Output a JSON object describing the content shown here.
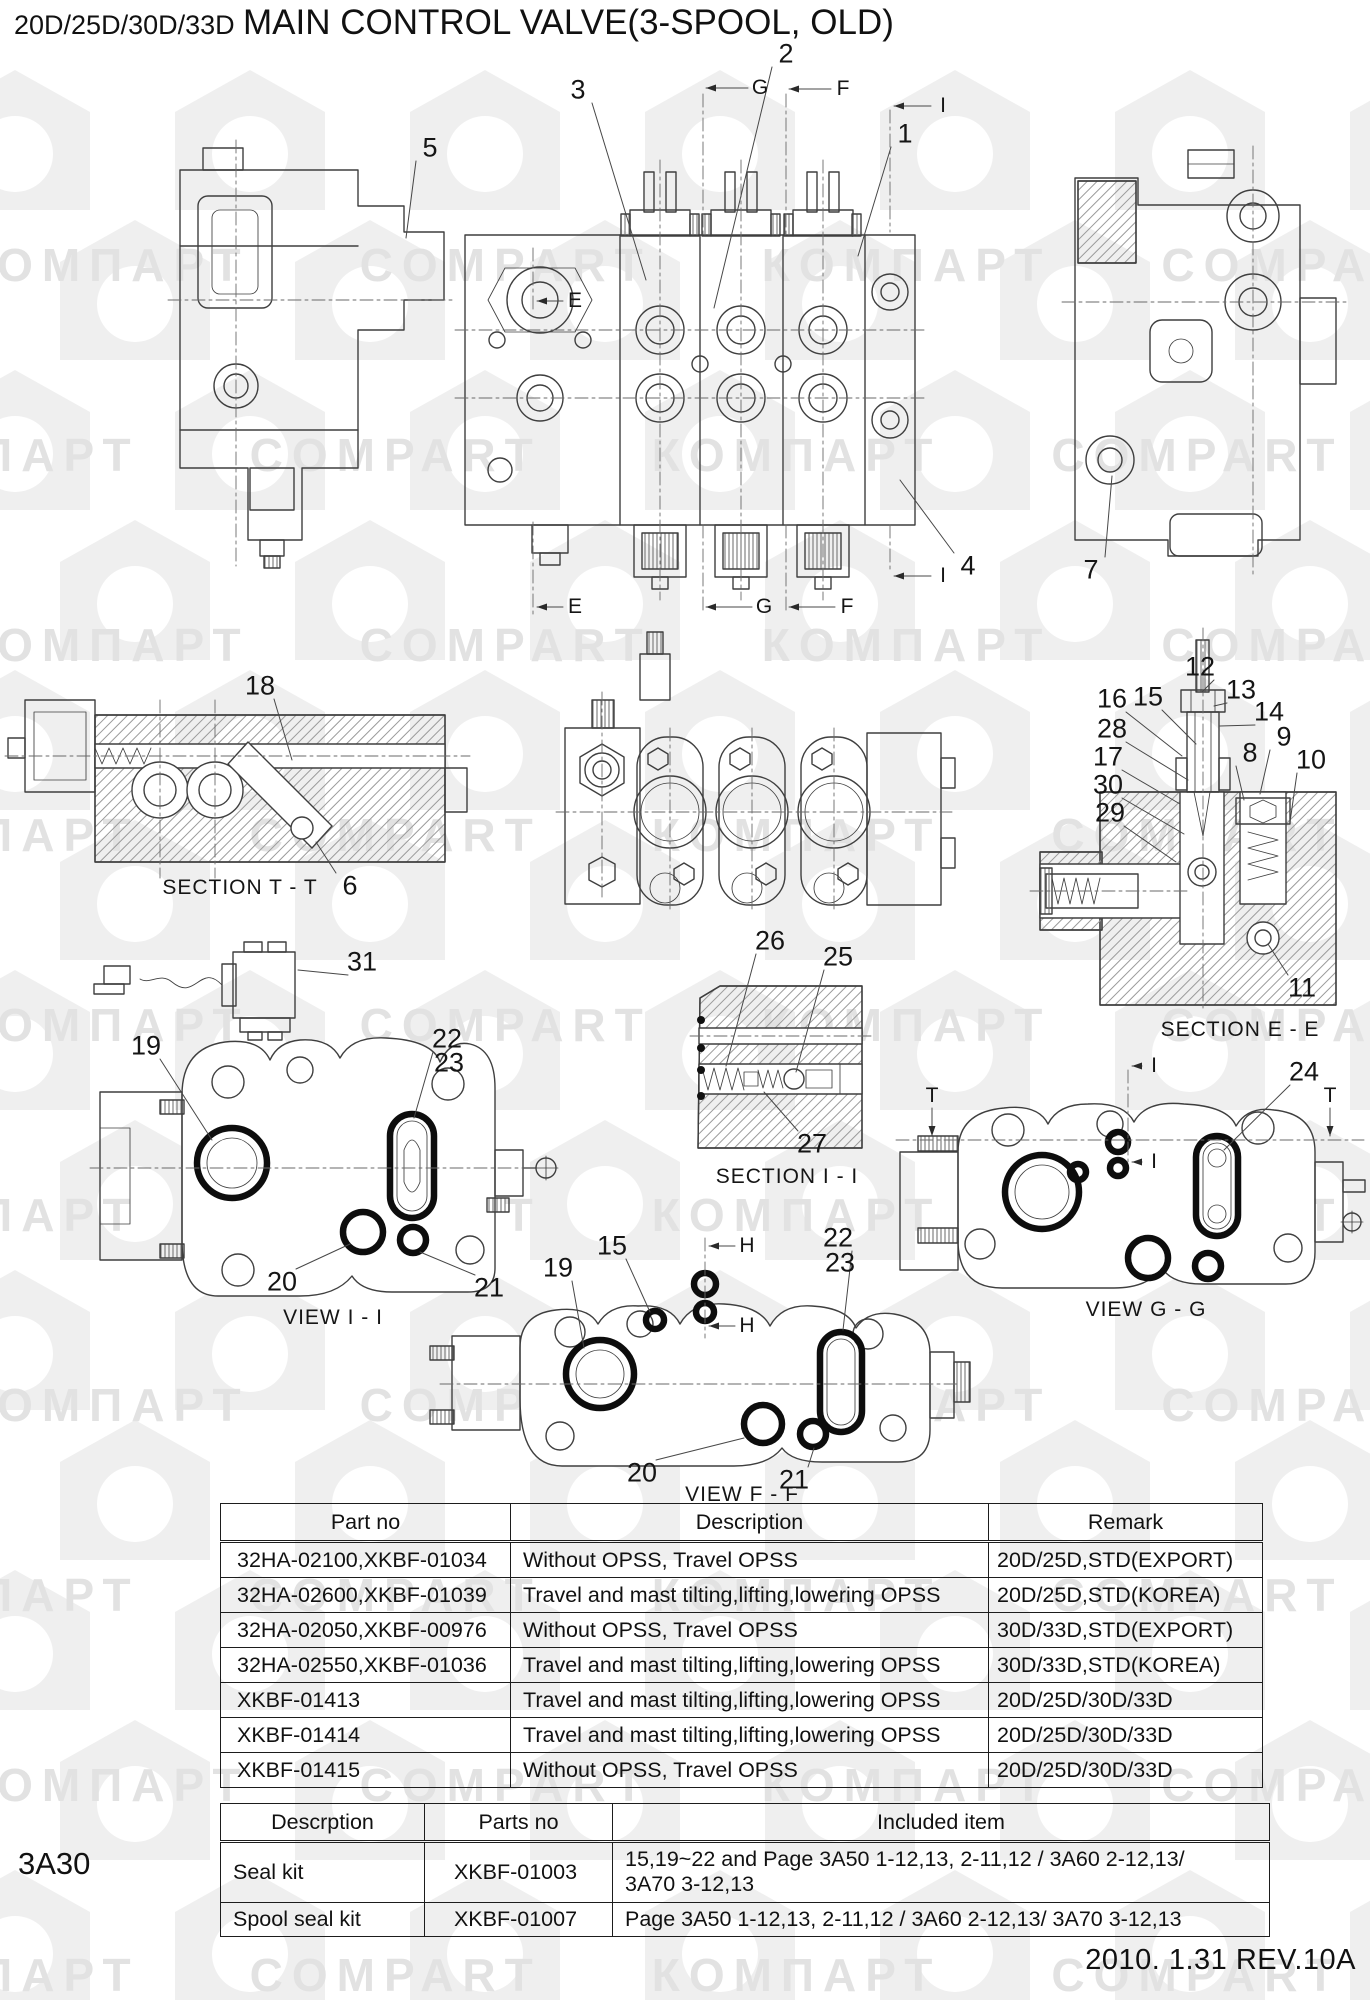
{
  "page": {
    "model": "20D/25D/30D/33D",
    "title": "MAIN CONTROL VALVE(3-SPOOL, OLD)",
    "page_code": "3A30",
    "revision": "2010. 1.31  REV.10A"
  },
  "watermark": {
    "cyrillic": "КОМПАРТ",
    "latin": "COMPART"
  },
  "diagram": {
    "callouts": [
      {
        "t": "1",
        "x": 905,
        "y": 134,
        "lx": 858,
        "ly": 256
      },
      {
        "t": "2",
        "x": 786,
        "y": 54,
        "lx": 714,
        "ly": 308
      },
      {
        "t": "3",
        "x": 578,
        "y": 90,
        "lx": 646,
        "ly": 280
      },
      {
        "t": "4",
        "x": 968,
        "y": 566,
        "lx": 900,
        "ly": 480
      },
      {
        "t": "5",
        "x": 430,
        "y": 148,
        "lx": 406,
        "ly": 238
      },
      {
        "t": "6",
        "x": 350,
        "y": 886,
        "lx": 316,
        "ly": 842
      },
      {
        "t": "7",
        "x": 1091,
        "y": 570,
        "lx": 1112,
        "ly": 476
      },
      {
        "t": "8",
        "x": 1250,
        "y": 753,
        "lx": 1244,
        "ly": 800
      },
      {
        "t": "9",
        "x": 1284,
        "y": 737,
        "lx": 1260,
        "ly": 794
      },
      {
        "t": "10",
        "x": 1311,
        "y": 760,
        "lx": 1290,
        "ly": 822
      },
      {
        "t": "11",
        "x": 1302,
        "y": 988,
        "lx": 1268,
        "ly": 944
      },
      {
        "t": "12",
        "x": 1200,
        "y": 667,
        "lx": 1202,
        "ly": 692
      },
      {
        "t": "13",
        "x": 1241,
        "y": 690,
        "lx": 1214,
        "ly": 706
      },
      {
        "t": "14",
        "x": 1269,
        "y": 712,
        "lx": 1220,
        "ly": 726
      },
      {
        "t": "15",
        "x": 1148,
        "y": 697,
        "lx": 1196,
        "ly": 744
      },
      {
        "t": "16",
        "x": 1112,
        "y": 699,
        "lx": 1182,
        "ly": 756
      },
      {
        "t": "17",
        "x": 1108,
        "y": 757,
        "lx": 1180,
        "ly": 804
      },
      {
        "t": "18",
        "x": 260,
        "y": 686,
        "lx": 292,
        "ly": 760
      },
      {
        "t": "19",
        "x": 146,
        "y": 1046,
        "lx": 212,
        "ly": 1140
      },
      {
        "t": "20",
        "x": 282,
        "y": 1282,
        "lx": 350,
        "ly": 1244
      },
      {
        "t": "21",
        "x": 489,
        "y": 1288,
        "lx": 420,
        "ly": 1252
      },
      {
        "t": "22",
        "x": 447,
        "y": 1039,
        "lx": 414,
        "ly": 1118
      },
      {
        "t": "23",
        "x": 449,
        "y": 1063
      },
      {
        "t": "24",
        "x": 1304,
        "y": 1072,
        "lx": 1224,
        "ly": 1150
      },
      {
        "t": "25",
        "x": 838,
        "y": 957,
        "lx": 796,
        "ly": 1072
      },
      {
        "t": "26",
        "x": 770,
        "y": 941,
        "lx": 726,
        "ly": 1066
      },
      {
        "t": "27",
        "x": 812,
        "y": 1144,
        "lx": 764,
        "ly": 1092
      },
      {
        "t": "28",
        "x": 1112,
        "y": 729,
        "lx": 1188,
        "ly": 780
      },
      {
        "t": "29",
        "x": 1110,
        "y": 813,
        "lx": 1176,
        "ly": 862
      },
      {
        "t": "30",
        "x": 1108,
        "y": 785,
        "lx": 1184,
        "ly": 834
      },
      {
        "t": "31",
        "x": 362,
        "y": 962,
        "lx": 298,
        "ly": 970
      },
      {
        "t": "15",
        "x": 612,
        "y": 1246,
        "lx": 650,
        "ly": 1312
      },
      {
        "t": "19",
        "x": 558,
        "y": 1268,
        "lx": 584,
        "ly": 1348
      },
      {
        "t": "20",
        "x": 642,
        "y": 1473,
        "lx": 744,
        "ly": 1438
      },
      {
        "t": "21",
        "x": 794,
        "y": 1480,
        "lx": 814,
        "ly": 1448
      },
      {
        "t": "22",
        "x": 838,
        "y": 1238,
        "lx": 843,
        "ly": 1330
      },
      {
        "t": "23",
        "x": 840,
        "y": 1263
      }
    ],
    "labels": [
      {
        "t": "SECTION T - T",
        "x": 240,
        "y": 888
      },
      {
        "t": "SECTION E - E",
        "x": 1240,
        "y": 1030
      },
      {
        "t": "SECTION I - I",
        "x": 787,
        "y": 1177
      },
      {
        "t": "VIEW I - I",
        "x": 333,
        "y": 1318
      },
      {
        "t": "VIEW G - G",
        "x": 1146,
        "y": 1310
      },
      {
        "t": "VIEW F - F",
        "x": 742,
        "y": 1495
      }
    ],
    "markers": [
      {
        "t": "G",
        "x": 760,
        "y": 88,
        "ax": 706,
        "ay": 88,
        "dir": "left"
      },
      {
        "t": "F",
        "x": 843,
        "y": 89,
        "ax": 789,
        "ay": 89,
        "dir": "left"
      },
      {
        "t": "I",
        "x": 943,
        "y": 106,
        "ax": 894,
        "ay": 106,
        "dir": "left"
      },
      {
        "t": "E",
        "x": 575,
        "y": 301,
        "ax": 537,
        "ay": 301,
        "dir": "left"
      },
      {
        "t": "E",
        "x": 575,
        "y": 607,
        "ax": 537,
        "ay": 607,
        "dir": "left"
      },
      {
        "t": "G",
        "x": 764,
        "y": 607,
        "ax": 706,
        "ay": 607,
        "dir": "left"
      },
      {
        "t": "F",
        "x": 847,
        "y": 607,
        "ax": 789,
        "ay": 607,
        "dir": "left"
      },
      {
        "t": "I",
        "x": 943,
        "y": 576,
        "ax": 894,
        "ay": 576,
        "dir": "left"
      },
      {
        "t": "T",
        "x": 932,
        "y": 1096,
        "ax": 932,
        "ay": 1136,
        "dir": "down"
      },
      {
        "t": "T",
        "x": 1330,
        "y": 1096,
        "ax": 1330,
        "ay": 1136,
        "dir": "down"
      },
      {
        "t": "I",
        "x": 1154,
        "y": 1066,
        "ax": 1132,
        "ay": 1066,
        "dir": "left"
      },
      {
        "t": "I",
        "x": 1154,
        "y": 1162,
        "ax": 1132,
        "ay": 1162,
        "dir": "left"
      },
      {
        "t": "H",
        "x": 747,
        "y": 1246,
        "ax": 709,
        "ay": 1246,
        "dir": "left"
      },
      {
        "t": "H",
        "x": 747,
        "y": 1326,
        "ax": 709,
        "ay": 1326,
        "dir": "left"
      }
    ]
  },
  "parts_table": {
    "headers": [
      "Part no",
      "Description",
      "Remark"
    ],
    "col_widths": [
      290,
      478,
      274
    ],
    "rows": [
      [
        "32HA-02100,XKBF-01034",
        "Without OPSS, Travel OPSS",
        "20D/25D,STD(EXPORT)"
      ],
      [
        "32HA-02600,XKBF-01039",
        "Travel and mast tilting,lifting,lowering OPSS",
        "20D/25D,STD(KOREA)"
      ],
      [
        "32HA-02050,XKBF-00976",
        "Without OPSS, Travel OPSS",
        "30D/33D,STD(EXPORT)"
      ],
      [
        "32HA-02550,XKBF-01036",
        "Travel and mast tilting,lifting,lowering OPSS",
        "30D/33D,STD(KOREA)"
      ],
      [
        "XKBF-01413",
        "Travel and mast tilting,lifting,lowering OPSS",
        "20D/25D/30D/33D"
      ],
      [
        "XKBF-01414",
        "Travel and mast tilting,lifting,lowering OPSS",
        "20D/25D/30D/33D"
      ],
      [
        "XKBF-01415",
        "Without OPSS, Travel OPSS",
        "20D/25D/30D/33D"
      ]
    ]
  },
  "kits_table": {
    "headers": [
      "Descrption",
      "Parts no",
      "Included item"
    ],
    "col_widths": [
      204,
      188,
      657
    ],
    "rows": [
      [
        "Seal kit",
        "XKBF-01003",
        "15,19~22 and Page 3A50 1-12,13, 2-11,12 / 3A60 2-12,13/\n3A70 3-12,13"
      ],
      [
        "Spool seal kit",
        "XKBF-01007",
        "Page 3A50 1-12,13, 2-11,12 / 3A60 2-12,13/ 3A70 3-12,13"
      ]
    ]
  }
}
